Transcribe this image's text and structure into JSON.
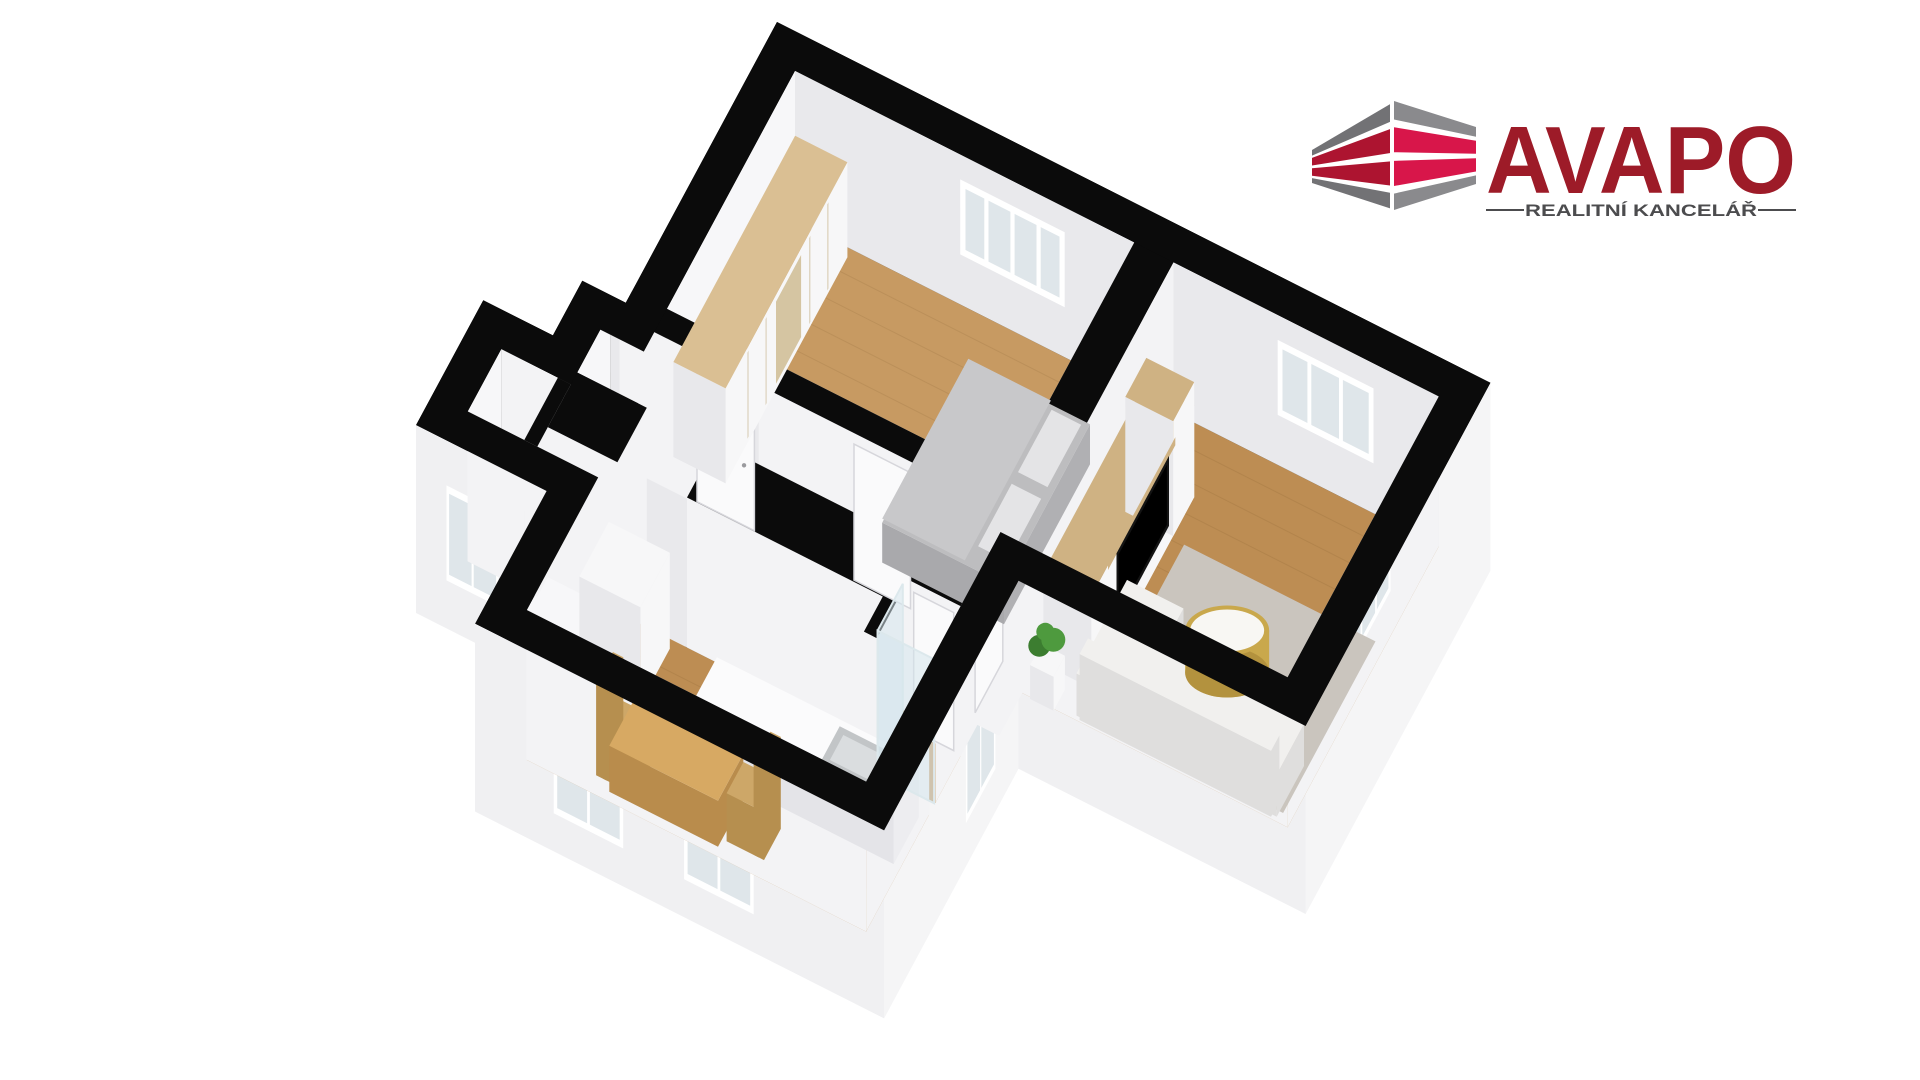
{
  "logo": {
    "brand": "AVAPO",
    "tagline": "REALITNÍ KANCELÁŘ",
    "brand_color": "#9d1b28",
    "tagline_color": "#4c4c4e",
    "icon": {
      "gray": "#727275",
      "gray_light": "#8a8a8d",
      "red_left": "#ad1430",
      "red_right": "#d8164a"
    }
  },
  "palette": {
    "background": "#ffffff",
    "wall_cut": "#0b0b0b",
    "ext_se": "#f5f5f6",
    "ext_sw": "#f0f0f2",
    "ext_w": "#eaeaec",
    "int_back_x": "#f7f7f9",
    "int_back_y": "#e9e9ec",
    "int_front": "#f3f3f5",
    "floor_wood": "#c79a62",
    "floor_wood_dark": "#bd8d53",
    "floor_gray": "#e3e3e5",
    "window_frame": "#ffffff",
    "window_pane": "#dfe6ea",
    "door": "#fafafb",
    "door_frame": "#d6d6db",
    "wardrobe_top": "#dabf93",
    "wardrobe_mirror": "#d5c5a2",
    "furniture_white": "#f7f7f8",
    "furniture_side": "#e8e8eb",
    "wood_top": "#cfb283",
    "bed_top": "#bdbdbf",
    "bed_side": "#a9a9ac",
    "bed_blanket": "#c8c8ca",
    "bed_pillow": "#e4e4e6",
    "tv_black": "#141414",
    "sofa_top": "#f1f0ee",
    "sofa_side": "#dfdedd",
    "rug": "#cac5be",
    "table_gold": "#c9a84c",
    "table_gold_dark": "#b3923e",
    "table_top_white": "#f8f7f3",
    "steel": "#c2c5c7",
    "steel_light": "#dadddf",
    "dining_top": "#d7a963",
    "dining_side": "#b98c4c",
    "chair": "#cda768",
    "plant_green": "#4e9a3e",
    "plant_green_dark": "#3c7d30",
    "glass": "rgba(213,230,236,0.55)",
    "glass_frame": "#dce8ec"
  },
  "scene": {
    "type": "3d-floorplan-render",
    "rooms": [
      {
        "name": "bedroom",
        "furniture": [
          "wardrobe",
          "double-bed"
        ]
      },
      {
        "name": "living-room",
        "furniture": [
          "tv-wall-unit",
          "tv",
          "plant",
          "rug",
          "sofa",
          "coffee-table"
        ]
      },
      {
        "name": "hallway",
        "furniture": []
      },
      {
        "name": "kitchen",
        "furniture": [
          "cabinet",
          "kitchen-island",
          "sink",
          "dining-table",
          "chairs"
        ]
      },
      {
        "name": "bathroom",
        "furniture": [
          "shower-glass"
        ]
      },
      {
        "name": "storage-room",
        "furniture": []
      },
      {
        "name": "wc",
        "furniture": []
      }
    ],
    "features": [
      "black-cut-walls",
      "wood-floors",
      "windows",
      "doors",
      "white-exterior-walls"
    ]
  }
}
